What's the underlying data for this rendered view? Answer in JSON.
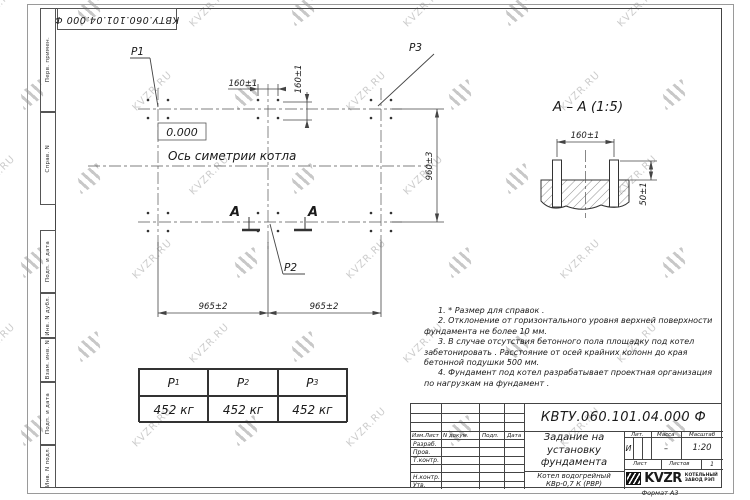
{
  "watermark": {
    "text": "KVZR.RU"
  },
  "corner_stamp": {
    "doc_number": "КВТУ.060.101.04.000 Ф"
  },
  "sidebar": {
    "labels": [
      "Перв. примен.",
      "Справ. N",
      "Подп. и дата",
      "Инв. N дубл.",
      "Взам. инв. N",
      "Подп. и дата",
      "Инв. N подл."
    ]
  },
  "plan": {
    "callout_p1": "P1",
    "callout_p2": "P2",
    "callout_p3": "P3",
    "level_mark": "0.000",
    "symmetry_axis_label": "Ось симетрии котла",
    "dim_bolt_spacing_h": "160±1",
    "dim_bolt_spacing_v": "160±1",
    "dim_width": "960±3",
    "dim_span_left": "965±2",
    "dim_span_right": "965±2",
    "section_mark_left": "А",
    "section_mark_right": "А"
  },
  "section_view": {
    "title": "А – А (1:5)",
    "dim_bolt_spacing": "160±1",
    "dim_bolt_height": "50±1"
  },
  "notes": {
    "items": [
      "1. * Размер для справок .",
      "2. Отклонение от горизонтального уровня верхней поверхности фундамента не более 10 мм.",
      "3. В случае отсутствия бетонного пола площадку под котел забетонировать . Расстояние от осей крайних колонн до края бетонной подушки 500 мм.",
      "4. Фундамент под котел разрабатывает проектная организация по нагрузкам на фундамент ."
    ]
  },
  "load_table": {
    "columns": [
      {
        "symbol": "P",
        "subscript": "1",
        "value": "452 кг"
      },
      {
        "symbol": "P",
        "subscript": "2",
        "value": "452 кг"
      },
      {
        "symbol": "P",
        "subscript": "3",
        "value": "452 кг"
      }
    ]
  },
  "title_block": {
    "doc_number": "КВТУ.060.101.04.000  Ф",
    "title": "Задание на установку фундамента",
    "product": "Котел водогрейный КВр-0,7 К (РВР)",
    "col_izm": "Изм.Лист",
    "col_doc": "N докум.",
    "col_sign": "Подп.",
    "col_date": "Дата",
    "row_razrab": "Разраб.",
    "row_prov": "Пров.",
    "row_tkontr": "Т.контр.",
    "row_nkontr": "Н.контр.",
    "row_utv": "Утв.",
    "lit_label": "Лит.",
    "mass_label": "Масса",
    "scale_label": "Масштаб",
    "lit_value": "И",
    "mass_value": "–",
    "scale_value": "1:20",
    "sheet_label": "Лист",
    "sheets_label": "Листов",
    "sheets_value": "1",
    "logo_text": "KVZR",
    "factory_name": "КОТЕЛЬНЫЙ ЗАВОД РЭП",
    "format_note": "Формат А3"
  }
}
